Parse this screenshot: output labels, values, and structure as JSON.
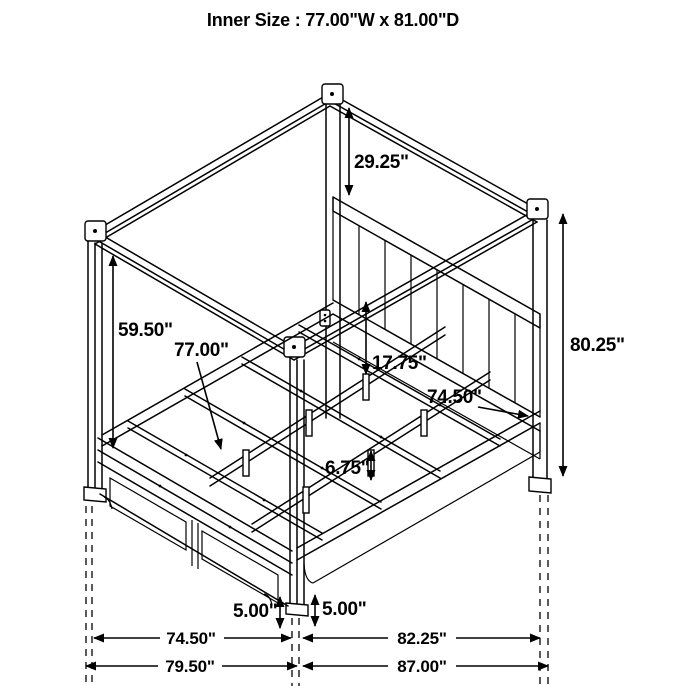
{
  "title": "Inner Size : 77.00\"W x 81.00\"D",
  "colors": {
    "line": "#000000",
    "background": "#ffffff"
  },
  "dimensions": {
    "canopy_drop": {
      "label": "29.25\"",
      "meaning": "canopy top to headboard top"
    },
    "left_post": {
      "label": "59.50\"",
      "meaning": "canopy beam to bed deck"
    },
    "slat_length": {
      "label": "77.00\"",
      "meaning": "slat length"
    },
    "rail_height": {
      "label": "17.75\"",
      "meaning": "rail top to slat level"
    },
    "headboard_rail": {
      "label": "74.50\"",
      "meaning": "inner rail length"
    },
    "post_height": {
      "label": "80.25\"",
      "meaning": "overall post height"
    },
    "leg_height": {
      "label": "6.75\"",
      "meaning": "support leg height"
    },
    "clearance_left": {
      "label": "5.00\"",
      "meaning": "floor clearance footboard side"
    },
    "clearance_right": {
      "label": "5.00\"",
      "meaning": "floor clearance rail side"
    },
    "width_inner": {
      "label": "74.50\"",
      "meaning": "width between posts"
    },
    "width_outer": {
      "label": "79.50\"",
      "meaning": "overall width"
    },
    "depth_inner": {
      "label": "82.25\"",
      "meaning": "depth between posts"
    },
    "depth_outer": {
      "label": "87.00\"",
      "meaning": "overall depth"
    }
  }
}
